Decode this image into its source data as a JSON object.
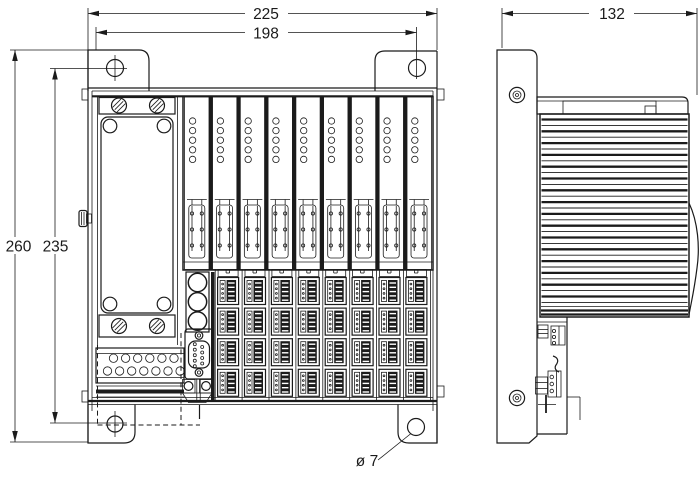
{
  "dimensions": {
    "overall_width": "225",
    "mounting_hole_spacing_horizontal": "198",
    "overall_height": "260",
    "mounting_hole_spacing_vertical": "235",
    "depth": "132",
    "mounting_hole_diameter": "ø 7"
  },
  "colors": {
    "line": "#1b1b1b",
    "background": "#ffffff"
  },
  "structure": {
    "io_modules": 9,
    "leds_per_module": 5,
    "terminal_columns": 8,
    "terminal_rows": 4,
    "heatsink_fins": 32,
    "front_fuse_circles": 3,
    "db9_pins_left_column": 5,
    "db9_pins_right_column": 4,
    "terminal_strip_top_circles": 6,
    "terminal_strip_bottom_circles": 7
  }
}
